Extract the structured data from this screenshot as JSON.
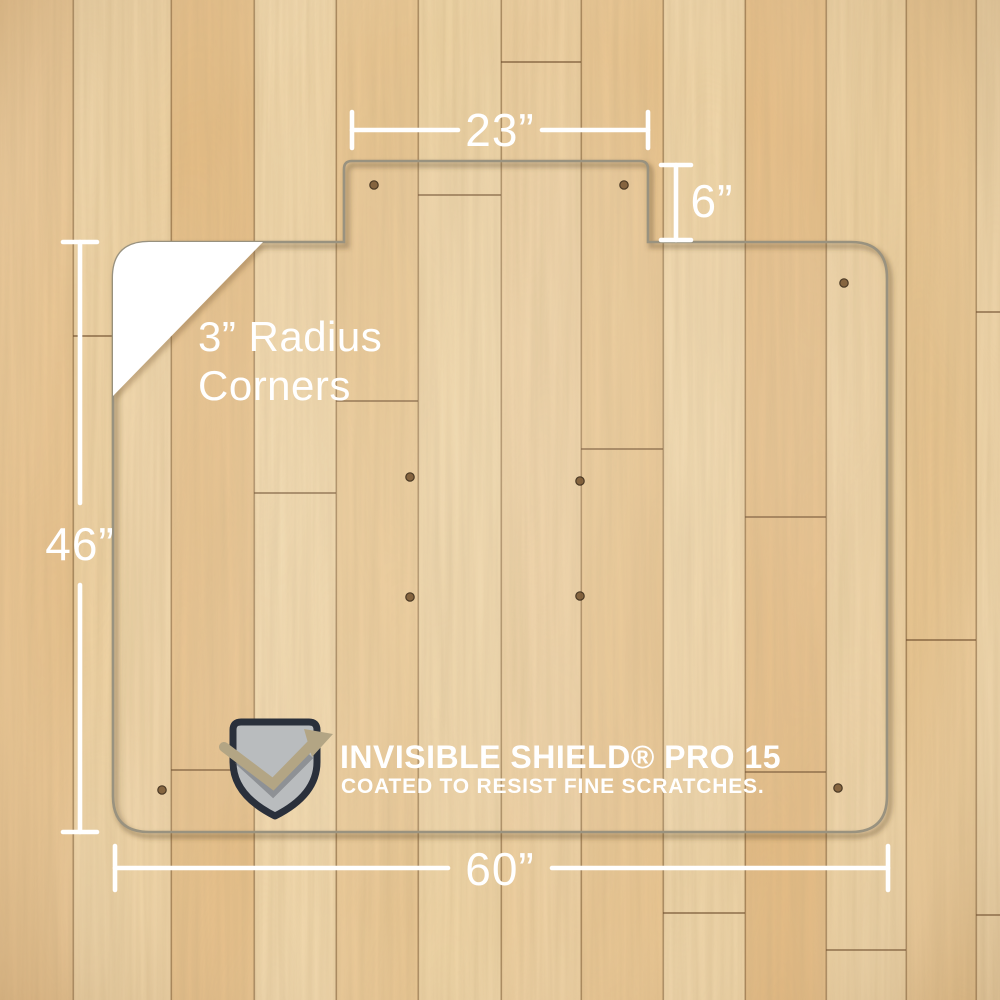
{
  "dimensions": {
    "tab_width": "23”",
    "tab_depth": "6”",
    "mat_height": "46”",
    "mat_width": "60”"
  },
  "corner_callout": {
    "line1": "3” Radius",
    "line2": "Corners"
  },
  "branding": {
    "title": "INVISIBLE SHIELD® PRO 15",
    "tagline": "COATED TO RESIST FINE SCRATCHES.",
    "logo": "shield-checkmark-icon"
  },
  "colors": {
    "annotation_white": "#ffffff",
    "floor_light": "#ecd0a0",
    "floor_dark": "#e2b67c",
    "mat_edge": "#99927f",
    "shield_fill": "#b9bcbe",
    "shield_outline": "#2a303b",
    "shield_check": "#b3a584"
  }
}
